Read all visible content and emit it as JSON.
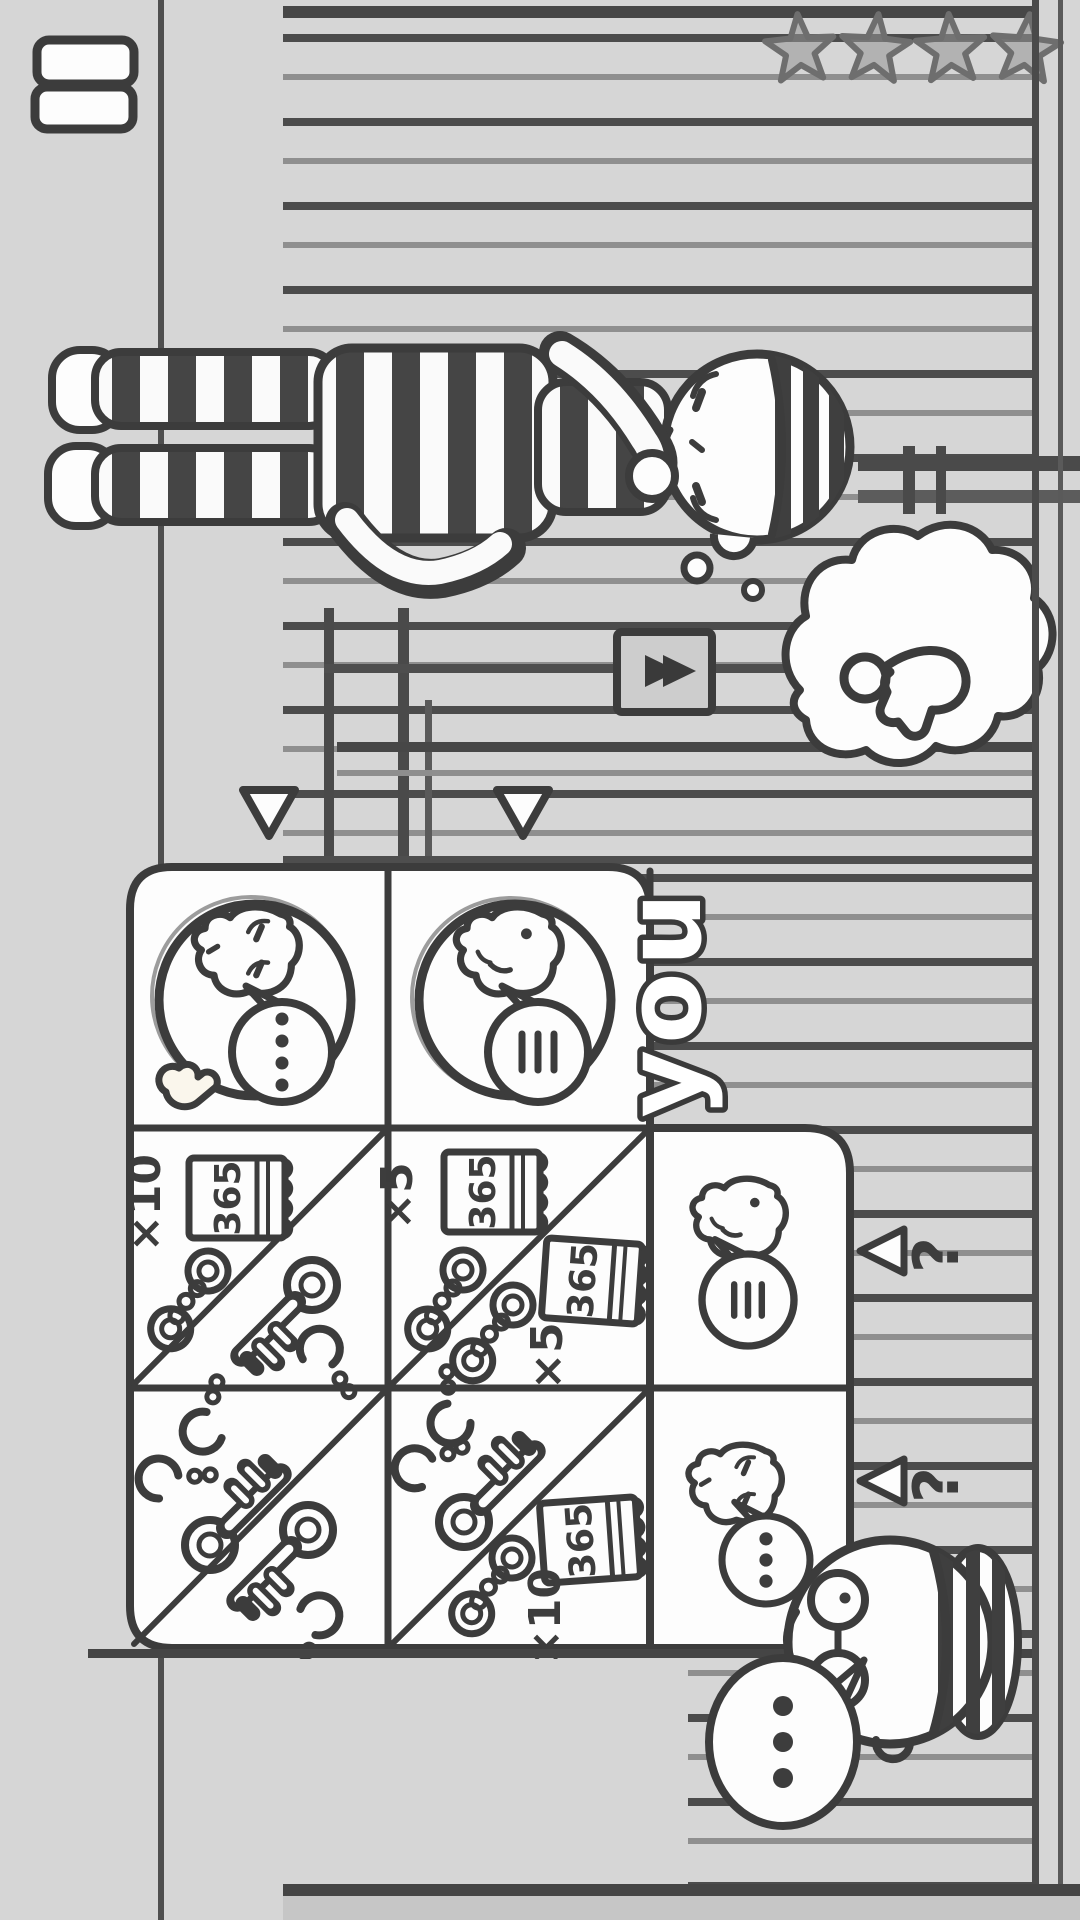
{
  "app": {
    "style": "hand-drawn-doodle",
    "bg_color": "#d6d6d6",
    "ink_color": "#3c3c3c",
    "rotation": "landscape game rotated 90deg CCW"
  },
  "hud": {
    "menu_button": {
      "icon": "menu-icon"
    },
    "rating": {
      "stars_count": 4,
      "icon": "star-icon"
    }
  },
  "labels": {
    "you": "you",
    "calendar": "365",
    "times5": "×5",
    "times10": "×10",
    "question": "?"
  },
  "scene": {
    "prisoner": {
      "name": "prisoner",
      "outfit": "striped-uniform",
      "pose": "standing-thinking",
      "thought_bubble": {
        "icon": "key-icon"
      }
    },
    "wall_sign": {
      "icon": "fast-forward-arrows-icon"
    },
    "cell_bars": true,
    "guard": {
      "name": "guard",
      "accessories": [
        "cap",
        "glasses"
      ],
      "speech_bubble": {
        "icon": "ellipsis-dots"
      }
    }
  },
  "trade_table": {
    "selection_arrows": 2,
    "partners": [
      {
        "id": "prisoner-calm",
        "speech": "ellipsis-dots",
        "hand_cursor": true
      },
      {
        "id": "prisoner-annoyed",
        "speech": "silence-lines"
      }
    ],
    "rows": [
      {
        "cells": [
          {
            "give": [
              "times10",
              "calendar-365",
              "handcuffs"
            ],
            "receive": [
              "key",
              "handcuffs-open"
            ]
          },
          {
            "give": [
              "times5",
              "calendar-365",
              "handcuffs"
            ],
            "receive": [
              "handcuffs",
              "calendar-365",
              "times5"
            ]
          },
          {
            "face": "prisoner-annoyed",
            "speech": "silence-lines",
            "indicator": "question"
          }
        ]
      },
      {
        "cells": [
          {
            "give": [
              "handcuffs-open",
              "key"
            ],
            "receive": [
              "key",
              "handcuffs-open"
            ]
          },
          {
            "give": [
              "handcuffs-open",
              "key"
            ],
            "receive": [
              "handcuffs",
              "calendar-365",
              "times10"
            ]
          },
          {
            "face": "prisoner-calm",
            "speech": "ellipsis-dots",
            "indicator": "question"
          }
        ]
      }
    ]
  }
}
